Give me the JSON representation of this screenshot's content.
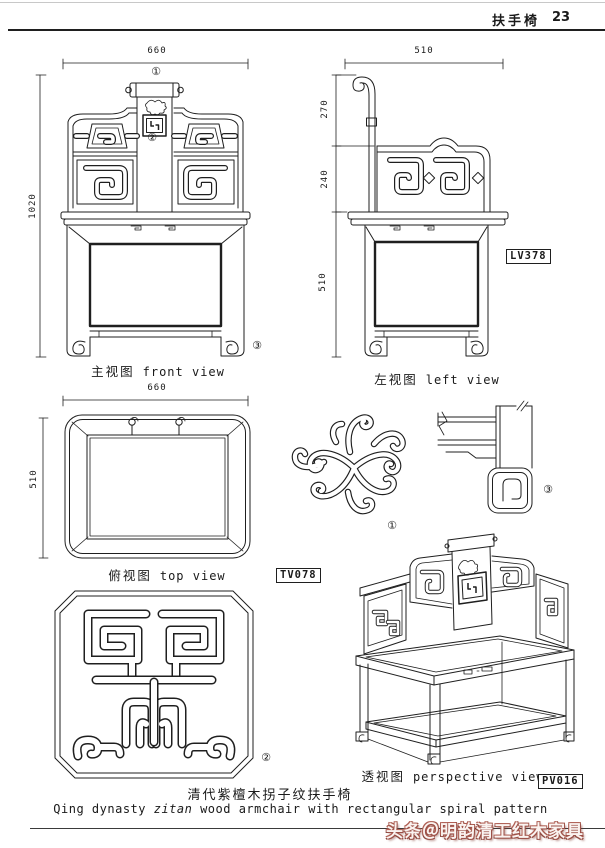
{
  "header": {
    "title": "扶手椅",
    "page": "23"
  },
  "views": {
    "front": {
      "caption_zh": "主视图",
      "caption_en": "front view",
      "dim_width": "660",
      "dim_height": "1020",
      "markers": {
        "m1": "①",
        "m2": "②",
        "m3": "③"
      }
    },
    "left": {
      "caption_zh": "左视图",
      "caption_en": "left view",
      "dim_width": "510",
      "dim_upper": "270",
      "dim_mid": "240",
      "dim_lower": "510",
      "code": "LV378"
    },
    "top": {
      "caption_zh": "俯视图",
      "caption_en": "top view",
      "dim_width": "660",
      "dim_depth": "510",
      "code": "TV078"
    },
    "perspective": {
      "caption_zh": "透视图",
      "caption_en": "perspective view",
      "code": "PV016"
    },
    "details": {
      "pattern_marker": "①",
      "medallion_marker": "②",
      "joint_marker": "③"
    }
  },
  "footer": {
    "title_zh": "清代紫檀木拐子纹扶手椅",
    "title_en_pre": "Qing  dynasty ",
    "title_en_italic": "zitan",
    "title_en_post": " wood armchair with rectangular spiral pattern",
    "watermark": "头条＠明韵清工红木家具"
  }
}
